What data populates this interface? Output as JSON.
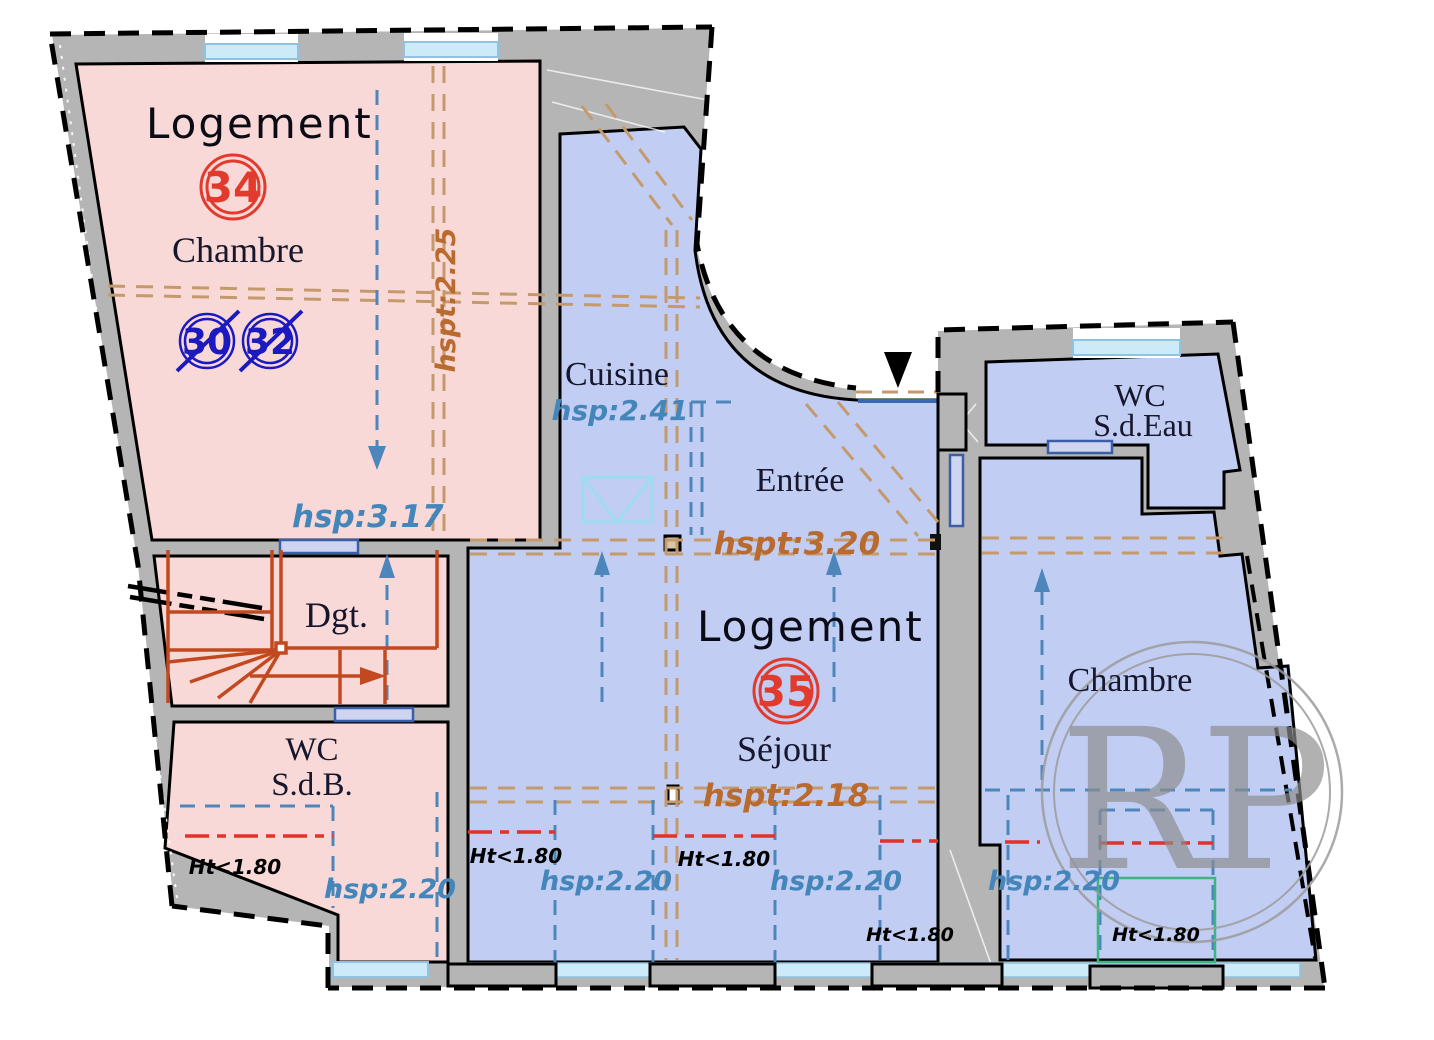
{
  "plan": {
    "apartment34": {
      "label": "Logement",
      "number": "34",
      "old_number_1": "30",
      "old_number_2": "32",
      "room_chambre": "Chambre",
      "room_dgt": "Dgt.",
      "room_wc_line1": "WC",
      "room_wc_line2": "S.d.B.",
      "height_hspt_225": "hspt:2.25",
      "height_hsp_317": "hsp:3.17",
      "height_hsp_220": "hsp:2.20",
      "height_ht_180": "Ht<1.80"
    },
    "apartment35": {
      "label": "Logement",
      "number": "35",
      "room_cuisine": "Cuisine",
      "room_entree": "Entrée",
      "room_sejour": "Séjour",
      "room_chambre": "Chambre",
      "room_wc_line1": "WC",
      "room_wc_line2": "S.d.Eau",
      "height_hsp_241": "hsp:2.41",
      "height_hspt_320": "hspt:3.20",
      "height_hspt_218": "hspt:2.18",
      "height_hsp_220": "hsp:2.20",
      "height_ht_180": "Ht<1.80"
    },
    "watermark": "RP",
    "colors": {
      "apartment34_fill": "#f9d9d7",
      "apartment35_fill": "#c1cdf3",
      "wall_gray": "#b5b5b5",
      "window_cyan": "#cdeaf8",
      "door_lavender": "#cfd4f0",
      "door_blue": "#3a68b0",
      "unit_circle_red": "#e23b2e",
      "old_number_blue": "#1a1ac0",
      "stairs_red": "#c2491f",
      "beam_tan_dash": "#c49a6c",
      "zone_blue_dash": "#4d86bb",
      "limit_red_dash": "#e3322a",
      "attic_green": "#3db583",
      "hsp_text_blue": "#4486ba",
      "hspt_text_orange": "#b96a2e"
    }
  }
}
